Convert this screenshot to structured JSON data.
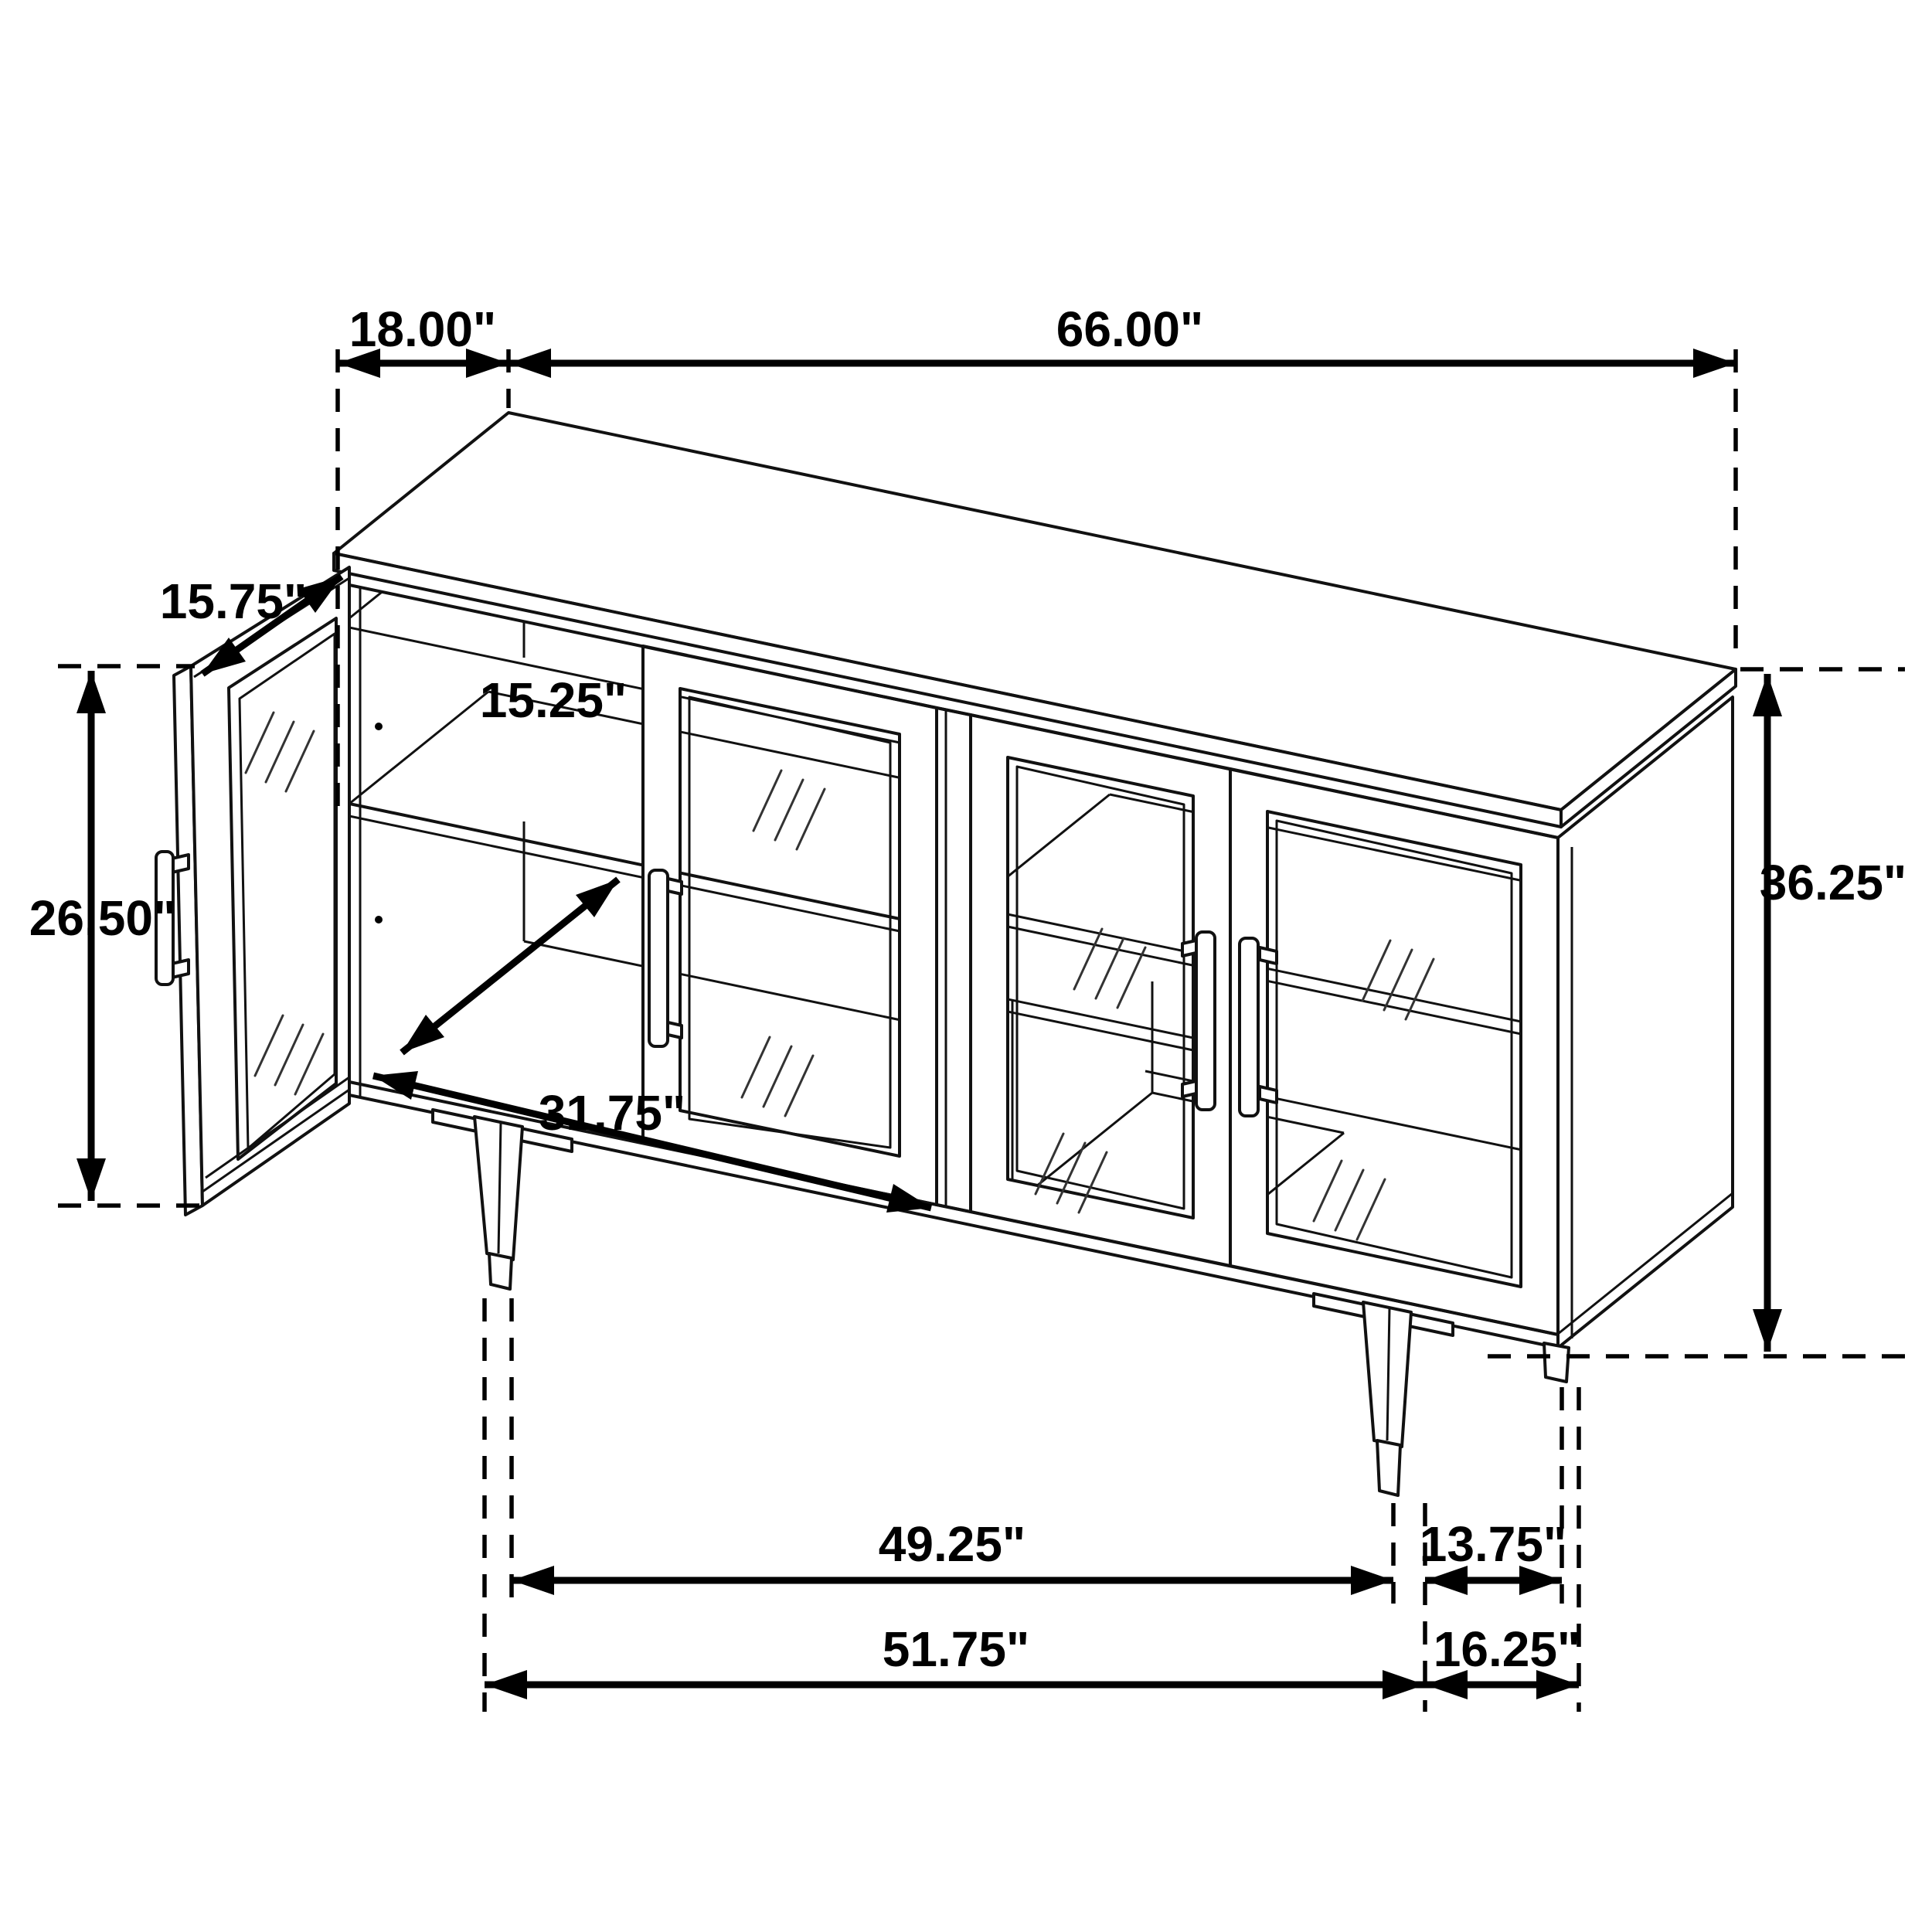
{
  "drawing": {
    "type": "furniture-dimension-diagram",
    "subject": "sideboard accent cabinet with glass doors, open left door, tapered legs",
    "units": "inches",
    "colors": {
      "line": "#111111",
      "dimension": "#000000",
      "background": "#ffffff"
    }
  },
  "dims": {
    "depth_top": {
      "label": "18.00\""
    },
    "width_top": {
      "label": "66.00\""
    },
    "door_width": {
      "label": "15.75\""
    },
    "shelf_depth": {
      "label": "15.25\""
    },
    "door_height": {
      "label": "26.50\""
    },
    "interior_width": {
      "label": "31.75\""
    },
    "overall_height": {
      "label": "36.25\""
    },
    "legs_span_inner": {
      "label": "49.25\""
    },
    "legs_depth_inner": {
      "label": "13.75\""
    },
    "legs_span_outer": {
      "label": "51.75\""
    },
    "legs_depth_outer": {
      "label": "16.25\""
    }
  }
}
